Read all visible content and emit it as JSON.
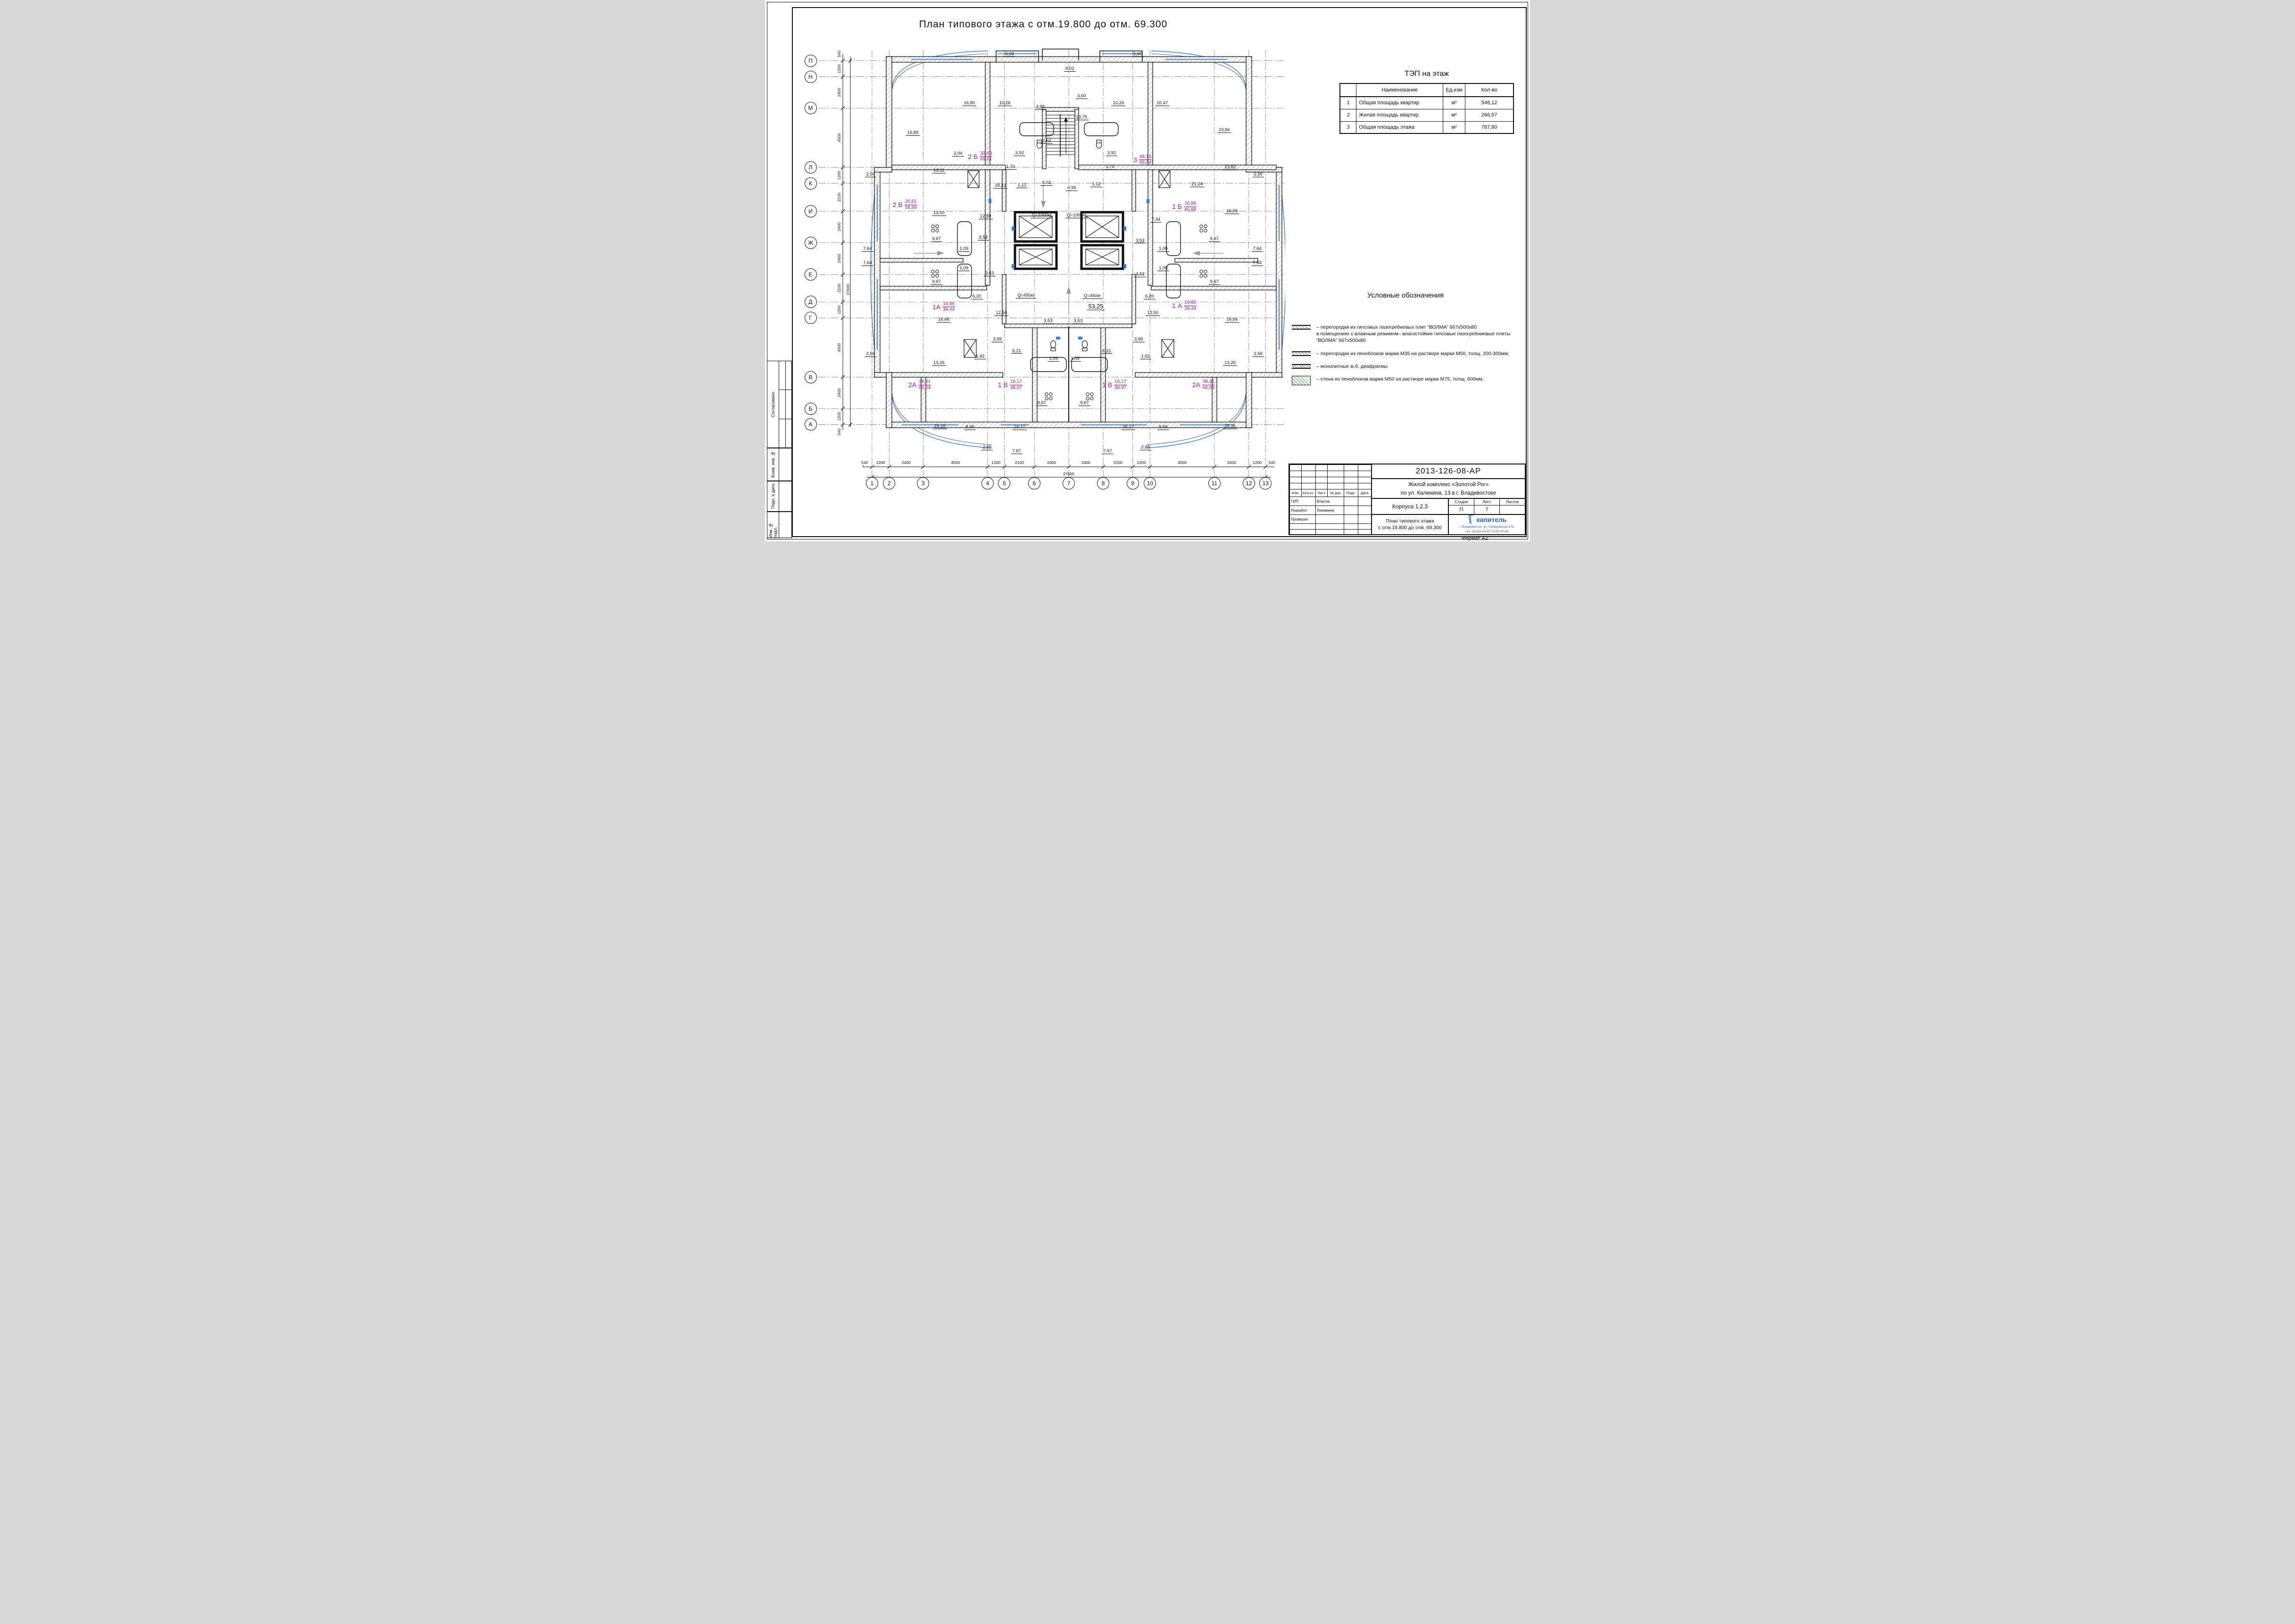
{
  "sheet": {
    "title": "План типового этажа с отм.19.800 до отм. 69.300",
    "format_label": "Формат А2"
  },
  "colors": {
    "accent_blue": "#2f7fe8",
    "apartment_magenta": "#a2199c",
    "logo_blue": "#2b5fd9"
  },
  "tep_table": {
    "title": "ТЭП на этаж",
    "columns": [
      "",
      "Наименование",
      "Ед.изм",
      "Кол-во"
    ],
    "rows": [
      {
        "n": "1",
        "name": "Общая площадь квартир",
        "unit": "м²",
        "value": "548,12"
      },
      {
        "n": "2",
        "name": "Жилая площадь квартир",
        "unit": "м²",
        "value": "266,57"
      },
      {
        "n": "3",
        "name": "Общая площадь этажа",
        "unit": "м²",
        "value": "787,80"
      }
    ]
  },
  "legend": {
    "title": "Условные обозначения",
    "items": [
      {
        "symbol": "hatch-gypsum",
        "text": "– перегородки из гипсовых пазогребневых плит “ВОЛМА” 667х500х80\nв помещениях с влажным режимом– влагостойкие гипсовые пазогребниевые плиты\n“ВОЛМА” 667х500х80"
      },
      {
        "symbol": "hatch-foam",
        "text": "– перегородки из пеноблоков марки М35 на растворе марки М50, толщ. 200-300мм;"
      },
      {
        "symbol": "hatch-monolith",
        "text": "– монолитные ж.б. диафрагмы"
      },
      {
        "symbol": "hatch-wall-600",
        "text": "– стена из пеноблоков марки М50 на растворе марки М75, толщ. 600мм;"
      }
    ]
  },
  "side_stamp": {
    "items": [
      "Согласовано",
      "Взам. инв. №",
      "Подп. и дата",
      "Инв. № подл."
    ]
  },
  "stamp": {
    "doc_number": "2013-126-08-АР",
    "project_line1": "Жилой комплекс «Золотой Рог»",
    "project_line2": "по ул. Калинина, 13 в г. Владивостоке",
    "object_name": "Корпуса 1,2,3",
    "sheet_title_line1": "План типового этажа",
    "sheet_title_line2": "с отм.19.800 до отм. 69.300",
    "header_cols": [
      "Изм.",
      "Кол.уч.",
      "Лист",
      "№ док.",
      "Подп.",
      "Дата"
    ],
    "roles": [
      {
        "role": "ГИП",
        "name": "Власов"
      },
      {
        "role": "Разработ",
        "name": "Ломакина"
      },
      {
        "role": "Проверил",
        "name": ""
      }
    ],
    "stage_label": "Стадия",
    "sheet_label": "Лист",
    "sheets_label": "Листов",
    "stage": "П",
    "sheet_no": "7",
    "sheets_total": "",
    "logo_text": "капитель",
    "logo_addr1": "г. Владивосток, ул. Хабаровская 27в",
    "logo_addr2": "тел. (4232) 43-57-73,43-57-69"
  },
  "plan": {
    "axes_x": [
      {
        "label": "1",
        "pct": 16.0
      },
      {
        "label": "2",
        "pct": 19.5
      },
      {
        "label": "3",
        "pct": 26.4
      },
      {
        "label": "4",
        "pct": 39.5
      },
      {
        "label": "5",
        "pct": 42.9
      },
      {
        "label": "6",
        "pct": 49.0
      },
      {
        "label": "7",
        "pct": 56.0
      },
      {
        "label": "8",
        "pct": 63.0
      },
      {
        "label": "9",
        "pct": 69.0
      },
      {
        "label": "10",
        "pct": 72.5
      },
      {
        "label": "11",
        "pct": 85.6
      },
      {
        "label": "12",
        "pct": 92.6
      },
      {
        "label": "13",
        "pct": 96.0
      }
    ],
    "axes_y": [
      {
        "label": "П",
        "pct": 3.8
      },
      {
        "label": "Н",
        "pct": 7.3
      },
      {
        "label": "М",
        "pct": 14.2
      },
      {
        "label": "Л",
        "pct": 27.2
      },
      {
        "label": "К",
        "pct": 30.7
      },
      {
        "label": "И",
        "pct": 36.8
      },
      {
        "label": "Ж",
        "pct": 43.7
      },
      {
        "label": "Е",
        "pct": 50.7
      },
      {
        "label": "Д",
        "pct": 56.7
      },
      {
        "label": "Г",
        "pct": 60.2
      },
      {
        "label": "В",
        "pct": 73.2
      },
      {
        "label": "Б",
        "pct": 80.1
      },
      {
        "label": "А",
        "pct": 83.6
      }
    ],
    "dims_bottom": {
      "segments": [
        "1200",
        "2400",
        "4500",
        "1200",
        "2100",
        "2400",
        "2400",
        "2100",
        "1200",
        "4500",
        "2400",
        "1200"
      ],
      "total": "27600",
      "edge": "540"
    },
    "dims_left": {
      "segments": [
        "1200",
        "2400",
        "4500",
        "1200",
        "2100",
        "2400",
        "2400",
        "2100",
        "1200",
        "4500",
        "2400",
        "1200"
      ],
      "total": "27600",
      "edge": "540"
    },
    "dim_labels": [
      {
        "t": "5,68",
        "x": 44.0,
        "y": 3.0
      },
      {
        "t": "5,68",
        "x": 70.0,
        "y": 3.0
      },
      {
        "t": "8,02",
        "x": 56.2,
        "y": 6.2
      },
      {
        "t": "16,80",
        "x": 35.8,
        "y": 13.8
      },
      {
        "t": "10,26",
        "x": 43.0,
        "y": 13.8
      },
      {
        "t": "4,99",
        "x": 50.2,
        "y": 14.6
      },
      {
        "t": "3,60",
        "x": 58.6,
        "y": 12.2
      },
      {
        "t": "13,75",
        "x": 58.6,
        "y": 16.9
      },
      {
        "t": "10,26",
        "x": 66.1,
        "y": 13.8
      },
      {
        "t": "10,47",
        "x": 75.0,
        "y": 13.8
      },
      {
        "t": "15,89",
        "x": 24.3,
        "y": 20.3
      },
      {
        "t": "2,62",
        "x": 51.5,
        "y": 22.0
      },
      {
        "t": "23,84",
        "x": 87.6,
        "y": 19.6
      },
      {
        "t": "2,04",
        "x": 33.5,
        "y": 24.8
      },
      {
        "t": "3,92",
        "x": 46.0,
        "y": 24.7
      },
      {
        "t": "3,92",
        "x": 64.7,
        "y": 24.7
      },
      {
        "t": "13,11",
        "x": 29.6,
        "y": 28.5
      },
      {
        "t": "1,70",
        "x": 44.2,
        "y": 27.7
      },
      {
        "t": "1,70",
        "x": 64.4,
        "y": 27.7
      },
      {
        "t": "13,82",
        "x": 88.8,
        "y": 27.8
      },
      {
        "t": "2,56",
        "x": 15.7,
        "y": 29.4
      },
      {
        "t": "2,56",
        "x": 94.5,
        "y": 29.4
      },
      {
        "t": "18,22",
        "x": 42.1,
        "y": 31.9
      },
      {
        "t": "1,12",
        "x": 46.5,
        "y": 31.7
      },
      {
        "t": "6,02",
        "x": 51.5,
        "y": 31.2
      },
      {
        "t": "0,95",
        "x": 56.6,
        "y": 32.4
      },
      {
        "t": "1,12",
        "x": 61.6,
        "y": 31.5
      },
      {
        "t": "21,24",
        "x": 82.1,
        "y": 31.5
      },
      {
        "t": "13,50",
        "x": 29.6,
        "y": 37.9
      },
      {
        "t": "12,89",
        "x": 39.1,
        "y": 38.6
      },
      {
        "t": "16,66",
        "x": 89.2,
        "y": 37.4
      },
      {
        "t": "Q=1000кг",
        "x": 50.5,
        "y": 38.4,
        "cls": "q"
      },
      {
        "t": "Q=1000кг",
        "x": 57.6,
        "y": 38.4,
        "cls": "q"
      },
      {
        "t": "7,44",
        "x": 73.7,
        "y": 39.3
      },
      {
        "t": "9,67",
        "x": 29.1,
        "y": 43.5
      },
      {
        "t": "3,53",
        "x": 38.6,
        "y": 43.2
      },
      {
        "t": "3,53",
        "x": 70.5,
        "y": 43.9
      },
      {
        "t": "9,67",
        "x": 85.6,
        "y": 43.5
      },
      {
        "t": "7,64",
        "x": 15.1,
        "y": 45.7
      },
      {
        "t": "1,09",
        "x": 34.7,
        "y": 45.7
      },
      {
        "t": "1,09",
        "x": 75.2,
        "y": 45.7
      },
      {
        "t": "7,64",
        "x": 94.3,
        "y": 45.7
      },
      {
        "t": "7,64",
        "x": 15.1,
        "y": 48.8
      },
      {
        "t": "7,64",
        "x": 94.3,
        "y": 48.8
      },
      {
        "t": "1,09",
        "x": 34.7,
        "y": 49.9
      },
      {
        "t": "1,09",
        "x": 75.2,
        "y": 49.9
      },
      {
        "t": "3,53",
        "x": 39.9,
        "y": 51.1
      },
      {
        "t": "3,53",
        "x": 70.5,
        "y": 51.3
      },
      {
        "t": "9,67",
        "x": 29.1,
        "y": 52.9
      },
      {
        "t": "9,67",
        "x": 85.6,
        "y": 52.9
      },
      {
        "t": "6,20",
        "x": 37.3,
        "y": 56.2
      },
      {
        "t": "Q=450кг",
        "x": 47.3,
        "y": 55.9,
        "cls": "q"
      },
      {
        "t": "Q=450кг",
        "x": 60.8,
        "y": 56.1,
        "cls": "q"
      },
      {
        "t": "6,20",
        "x": 72.4,
        "y": 56.2
      },
      {
        "t": "53,25",
        "x": 61.5,
        "y": 58.5,
        "cls": "big"
      },
      {
        "t": "16,66",
        "x": 30.6,
        "y": 61.2
      },
      {
        "t": "12,50",
        "x": 42.3,
        "y": 59.8
      },
      {
        "t": "12,50",
        "x": 73.1,
        "y": 59.8
      },
      {
        "t": "16,66",
        "x": 89.2,
        "y": 61.2
      },
      {
        "t": "3,53",
        "x": 51.8,
        "y": 61.5
      },
      {
        "t": "3,53",
        "x": 57.9,
        "y": 61.5
      },
      {
        "t": "3,99",
        "x": 41.5,
        "y": 65.6
      },
      {
        "t": "3,99",
        "x": 70.2,
        "y": 65.6
      },
      {
        "t": "6,21",
        "x": 45.4,
        "y": 68.1
      },
      {
        "t": "6,21",
        "x": 63.7,
        "y": 68.1
      },
      {
        "t": "2,56",
        "x": 15.7,
        "y": 68.8
      },
      {
        "t": "2,56",
        "x": 94.5,
        "y": 68.8
      },
      {
        "t": "1,09",
        "x": 52.9,
        "y": 69.8
      },
      {
        "t": "1,09",
        "x": 57.3,
        "y": 69.8
      },
      {
        "t": "1,62",
        "x": 38.0,
        "y": 69.3
      },
      {
        "t": "1,62",
        "x": 71.6,
        "y": 69.3
      },
      {
        "t": "13,26",
        "x": 29.6,
        "y": 70.7
      },
      {
        "t": "13,26",
        "x": 88.8,
        "y": 70.7
      },
      {
        "t": "9,67",
        "x": 50.5,
        "y": 79.5
      },
      {
        "t": "9,67",
        "x": 59.2,
        "y": 79.5
      },
      {
        "t": "25,15",
        "x": 29.8,
        "y": 84.6
      },
      {
        "t": "8,56",
        "x": 35.9,
        "y": 84.8
      },
      {
        "t": "16,17",
        "x": 46.0,
        "y": 84.8
      },
      {
        "t": "16,17",
        "x": 68.1,
        "y": 84.8
      },
      {
        "t": "8,56",
        "x": 75.2,
        "y": 84.8
      },
      {
        "t": "25,15",
        "x": 88.8,
        "y": 84.6
      },
      {
        "t": "2,65",
        "x": 39.4,
        "y": 89.2
      },
      {
        "t": "7,67",
        "x": 45.4,
        "y": 90.1
      },
      {
        "t": "7,67",
        "x": 63.9,
        "y": 90.1
      },
      {
        "t": "2,65",
        "x": 71.6,
        "y": 89.2
      }
    ],
    "apt_labels": [
      {
        "t": "2 Б",
        "num": "32,69",
        "den": "69,61",
        "x": 38.0,
        "y": 24.8
      },
      {
        "t": "3",
        "num": "48,13",
        "den": "88,84",
        "x": 71.0,
        "y": 25.5
      },
      {
        "t": "2 В",
        "num": "26,61",
        "den": "58,89",
        "x": 22.7,
        "y": 35.4
      },
      {
        "t": "1 Б",
        "num": "16,66",
        "den": "40,68",
        "x": 79.5,
        "y": 35.8
      },
      {
        "t": "1А",
        "num": "16,66",
        "den": "39,44",
        "x": 30.6,
        "y": 57.8
      },
      {
        "t": "1 А",
        "num": "16,66",
        "den": "39,44",
        "x": 79.5,
        "y": 57.5
      },
      {
        "t": "2А",
        "num": "38,41",
        "den": "66,64",
        "x": 25.7,
        "y": 74.9
      },
      {
        "t": "1 В",
        "num": "16,17",
        "den": "38,97",
        "x": 44.1,
        "y": 74.9
      },
      {
        "t": "1 В",
        "num": "16,17",
        "den": "38,97",
        "x": 65.3,
        "y": 74.9
      },
      {
        "t": "2А",
        "num": "38,41",
        "den": "66,64",
        "x": 83.4,
        "y": 74.9
      }
    ]
  }
}
